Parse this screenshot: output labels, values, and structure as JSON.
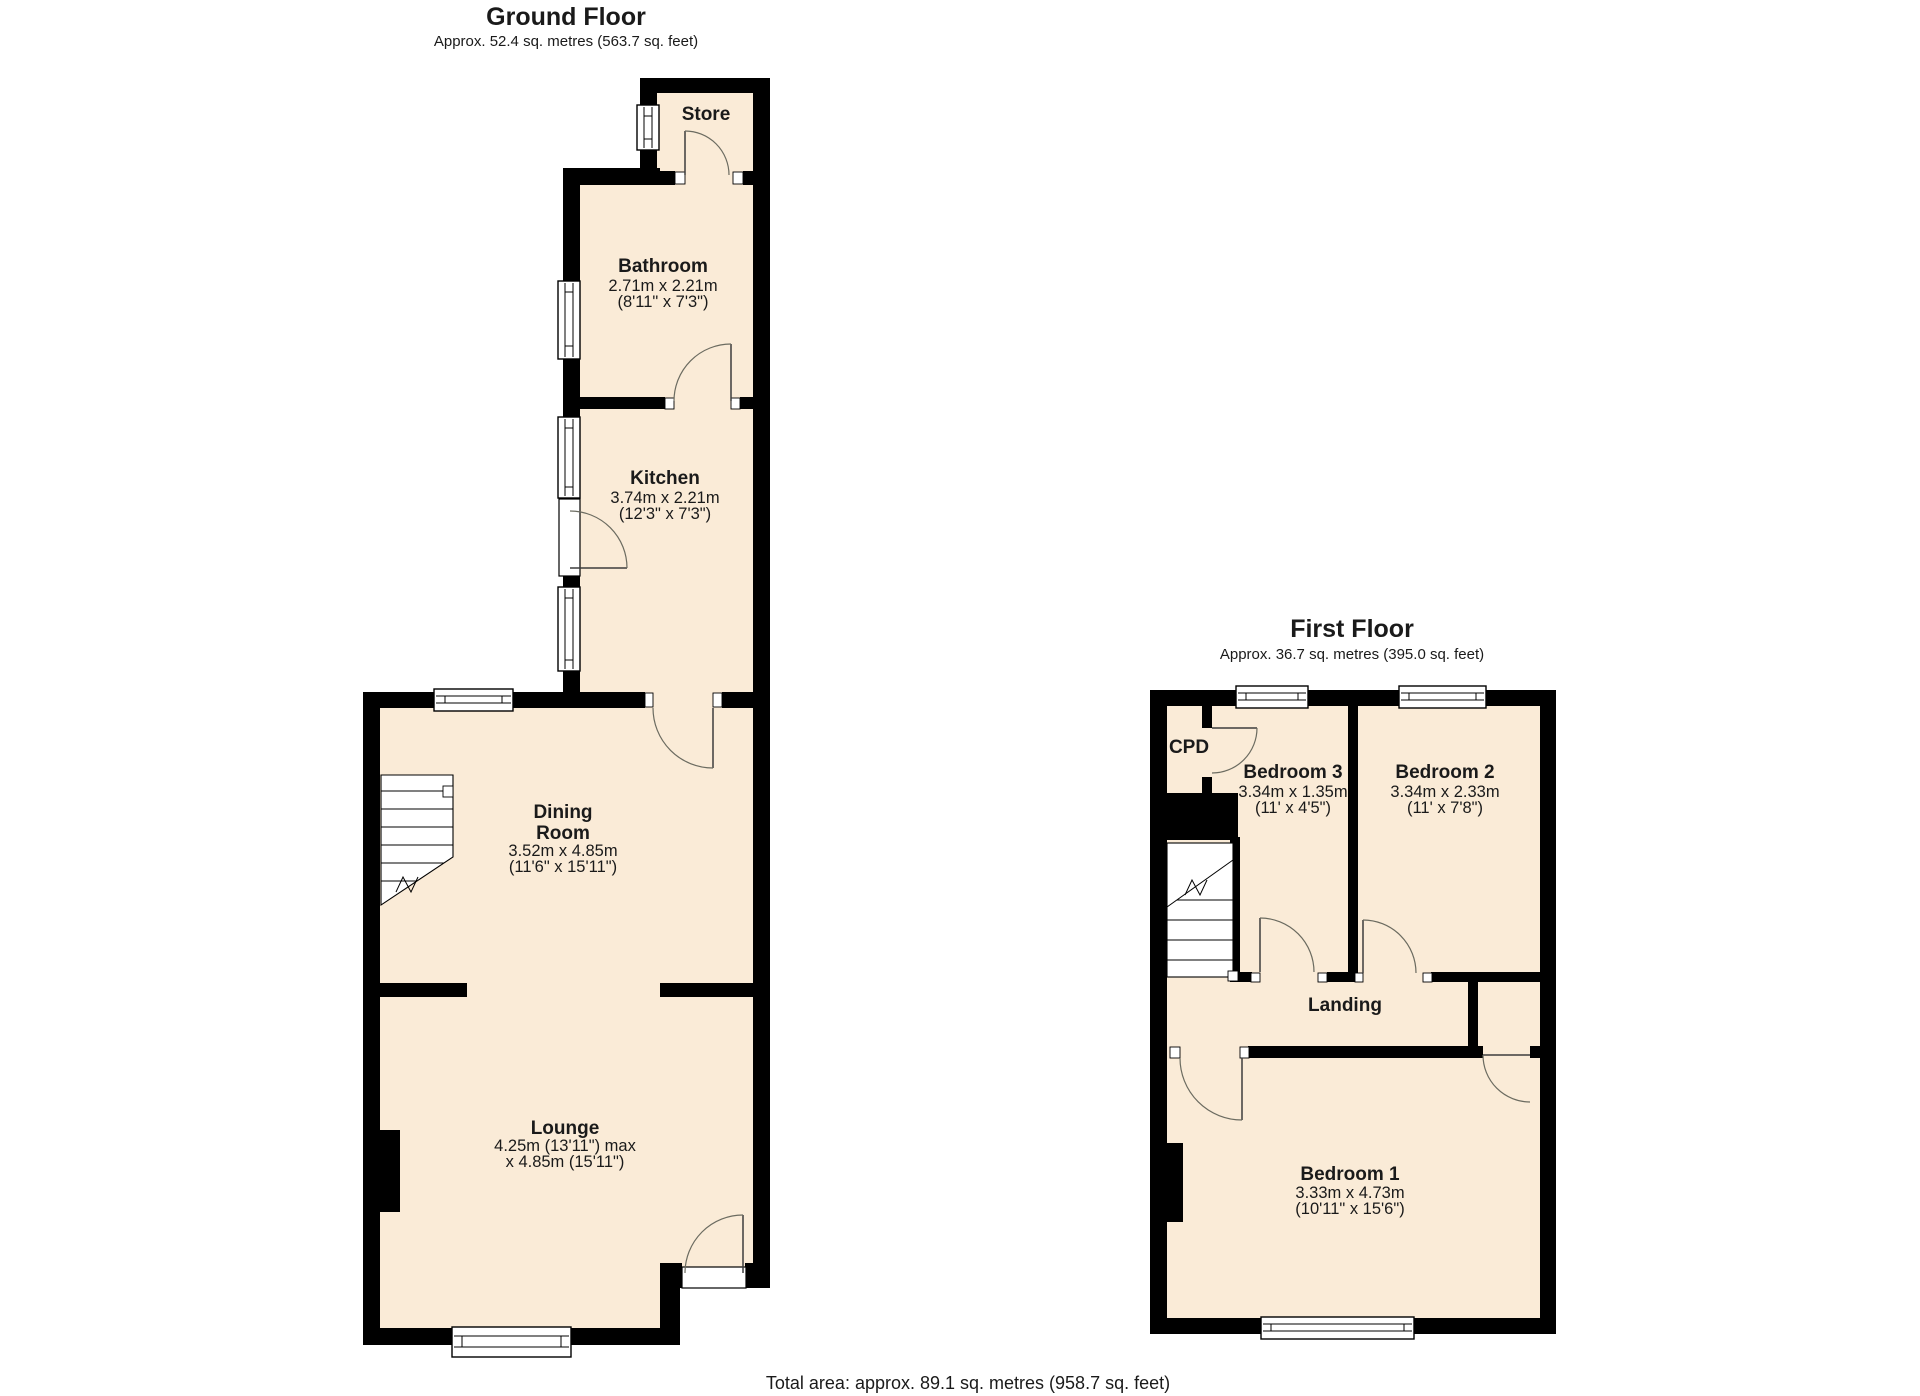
{
  "colors": {
    "background": "#ffffff",
    "floor_fill": "#faebd7",
    "wall": "#000000"
  },
  "ground": {
    "title": "Ground Floor",
    "subtitle": "Approx. 52.4 sq. metres (563.7 sq. feet)",
    "rooms": {
      "store": {
        "name": "Store"
      },
      "bathroom": {
        "name": "Bathroom",
        "dim_m": "2.71m x 2.21m",
        "dim_ft": "(8'11\" x 7'3\")"
      },
      "kitchen": {
        "name": "Kitchen",
        "dim_m": "3.74m x 2.21m",
        "dim_ft": "(12'3\" x 7'3\")"
      },
      "dining": {
        "name_line1": "Dining",
        "name_line2": "Room",
        "dim_m": "3.52m x 4.85m",
        "dim_ft": "(11'6\" x 15'11\")"
      },
      "lounge": {
        "name": "Lounge",
        "dim_line1": "4.25m (13'11\") max",
        "dim_line2": "x 4.85m (15'11\")"
      }
    }
  },
  "first": {
    "title": "First Floor",
    "subtitle": "Approx. 36.7 sq. metres (395.0 sq. feet)",
    "rooms": {
      "cpd": {
        "name": "CPD"
      },
      "bedroom3": {
        "name": "Bedroom 3",
        "dim_m": "3.34m x 1.35m",
        "dim_ft": "(11' x 4'5\")"
      },
      "bedroom2": {
        "name": "Bedroom 2",
        "dim_m": "3.34m x 2.33m",
        "dim_ft": "(11' x 7'8\")"
      },
      "landing": {
        "name": "Landing"
      },
      "bedroom1": {
        "name": "Bedroom 1",
        "dim_m": "3.33m x 4.73m",
        "dim_ft": "(10'11\" x 15'6\")"
      }
    }
  },
  "footer": {
    "total_area": "Total area: approx. 89.1 sq. metres (958.7 sq. feet)"
  }
}
